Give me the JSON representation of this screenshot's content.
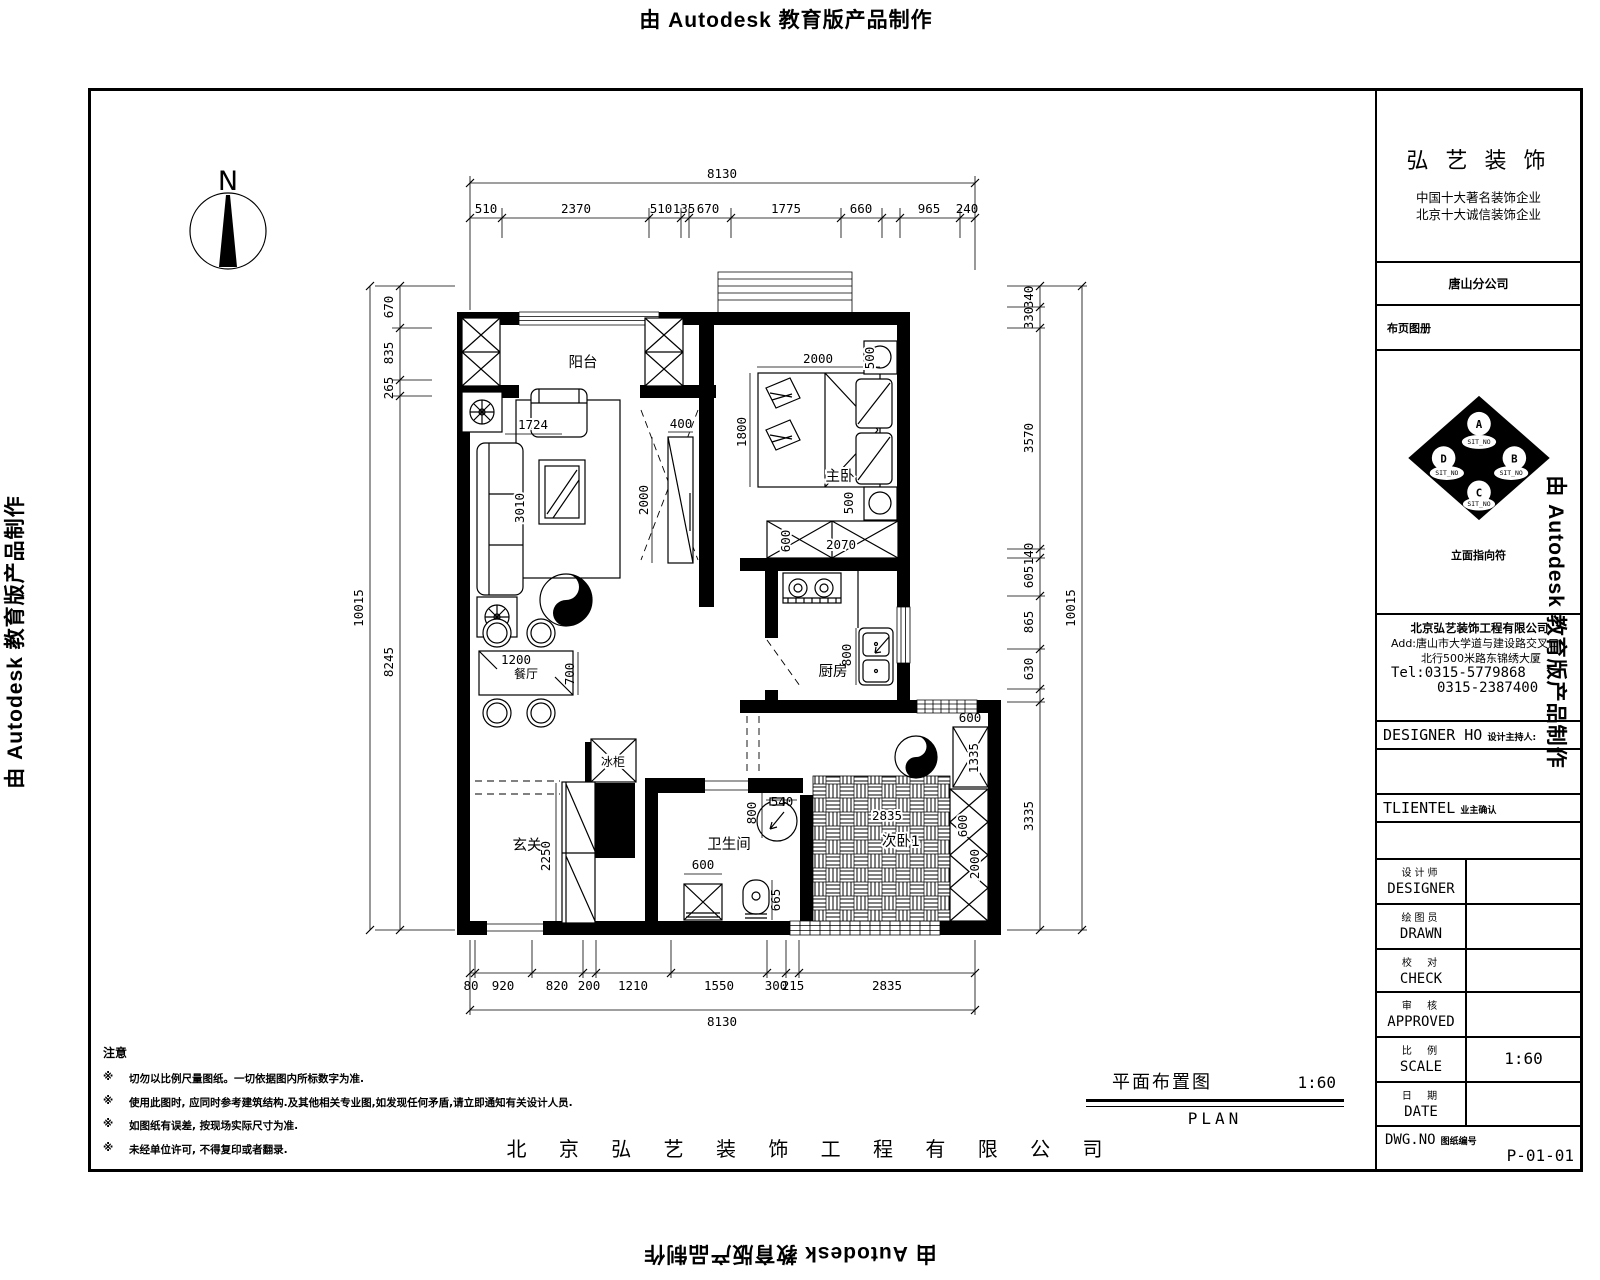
{
  "watermark": "由 Autodesk 教育版产品制作",
  "north_label": "N",
  "title_block": {
    "company_name": "弘 艺 装 饰",
    "slogan_line1": "中国十大著名装饰企业",
    "slogan_line2": "北京十大诚信装饰企业",
    "branch": "唐山分公司",
    "sheet_catalog": "布页图册",
    "elevation_symbol": {
      "top": "A",
      "right": "B",
      "bottom": "C",
      "left": "D",
      "sit_no": "SIT_NO",
      "caption": "立面指向符"
    },
    "company_full": "北京弘艺装饰工程有限公司",
    "address_line1": "Add:唐山市大学道与建设路交叉口",
    "address_line2": "北行500米路东锦绣大厦",
    "tel_line1": "Tel:0315-5779868",
    "tel_line2": "0315-2387400",
    "designer_host_en": "DESIGNER HO",
    "designer_host_cn": "设计主持人:",
    "client_en": "TLIENTEL",
    "client_cn": "业主确认",
    "fields": [
      {
        "cn": "设计师",
        "en": "DESIGNER",
        "value": ""
      },
      {
        "cn": "绘图员",
        "en": "DRAWN",
        "value": ""
      },
      {
        "cn": "校  对",
        "en": "CHECK",
        "value": ""
      },
      {
        "cn": "审  核",
        "en": "APPROVED",
        "value": ""
      },
      {
        "cn": "比  例",
        "en": "SCALE",
        "value": "1:60"
      },
      {
        "cn": "日  期",
        "en": "DATE",
        "value": ""
      }
    ],
    "dwg_en": "DWG.NO",
    "dwg_cn": "图纸编号",
    "dwg_value": "P-01-01"
  },
  "caption": {
    "title": "平面布置图",
    "scale": "1:60",
    "subtitle": "PLAN"
  },
  "footer_company": "北 京 弘 艺 装 饰 工 程 有 限 公 司",
  "notes": {
    "title": "注意",
    "marker": "※",
    "items": [
      "切勿以比例尺量图纸。一切依据图内所标数字为准.",
      "使用此图时, 应同时参考建筑结构.及其他相关专业图,如发现任何矛盾,请立即通知有关设计人员.",
      "如图纸有误差, 按现场实际尺寸为准.",
      "未经单位许可, 不得复印或者翻录."
    ]
  },
  "rooms": {
    "balcony": "阳台",
    "master_bedroom": "主卧",
    "kitchen": "厨房",
    "bathroom": "卫生间",
    "bedroom2": "次卧1",
    "entry": "玄关",
    "dining": "餐厅",
    "fridge": "冰柜"
  },
  "dims": {
    "top": {
      "overall": "8130",
      "segments": [
        "510",
        "2370",
        "510",
        "135",
        "670",
        "1775",
        "660",
        "965",
        "240"
      ]
    },
    "bottom": {
      "overall": "8130",
      "segments": [
        "80",
        "920",
        "820",
        "200",
        "1210",
        "1550",
        "300",
        "215",
        "2835"
      ]
    },
    "left": {
      "overall": "10015",
      "segments": [
        "670",
        "835",
        "265",
        "8245"
      ]
    },
    "right": {
      "overall": "10015",
      "segments": [
        "340",
        "330",
        "3570",
        "140",
        "605",
        "865",
        "630",
        "3335"
      ]
    },
    "interior": {
      "living_width": "1724",
      "sofa_length": "3010",
      "tv_depth": "400",
      "tv_length": "2000",
      "dining_table_width": "1200",
      "dining_table_depth": "700",
      "bed_width": "2000",
      "bed_length": "1800",
      "nightstand_top": "500",
      "nightstand_bottom": "500",
      "wardrobe_length": "2070",
      "wardrobe_depth": "600",
      "stove_width": "750",
      "kitchen_sink": "800",
      "closet_width": "600",
      "closet_length": "1335",
      "basin_width": "540",
      "basin_clear": "800",
      "toilet_clear": "665",
      "washer_width": "600",
      "shoe_cabinet_length": "2250",
      "bedroom2_width": "2835",
      "bedroom2_wardrobe_width": "600",
      "bedroom2_wardrobe_length": "2000"
    }
  }
}
